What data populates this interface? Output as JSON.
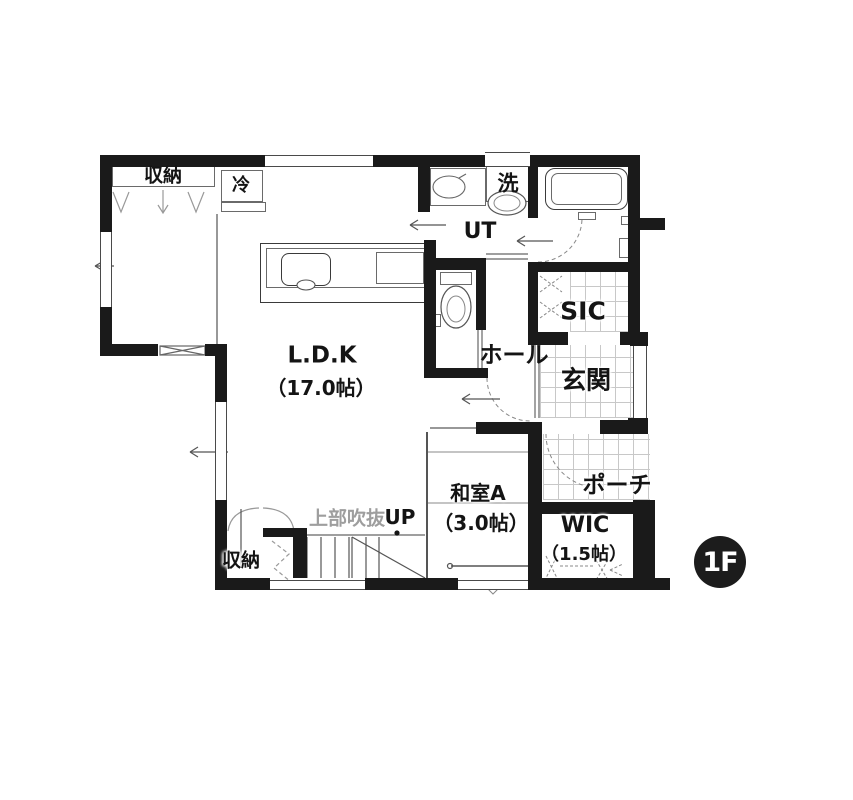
{
  "floor_badge": "1F",
  "rooms": {
    "ldk": {
      "name": "L.D.K",
      "size": "（17.0帖）"
    },
    "washitsu_a": {
      "name": "和室A",
      "size": "（3.0帖）"
    },
    "wic": {
      "name": "WIC",
      "size": "（1.5帖）"
    },
    "ut": {
      "name": "UT"
    },
    "sic": {
      "name": "SIC"
    },
    "hall": {
      "name": "ホール"
    },
    "entrance": {
      "name": "玄関"
    },
    "porch": {
      "name": "ポーチ"
    },
    "storage_upper": {
      "name": "収納"
    },
    "storage_lower": {
      "name": "収納"
    }
  },
  "fixtures": {
    "refrigerator": {
      "label": "冷"
    },
    "washing_machine": {
      "label": "洗"
    }
  },
  "annotations": {
    "void_above": "上部吹抜",
    "stairs_up": "UP"
  },
  "colors": {
    "wall": "#1a1a1a",
    "line": "#555555",
    "tile_line": "#c8c8c8",
    "muted_text": "#9e9e9e",
    "badge_bg": "#1c1c1c",
    "badge_text": "#ffffff",
    "label_text": "#141414"
  }
}
